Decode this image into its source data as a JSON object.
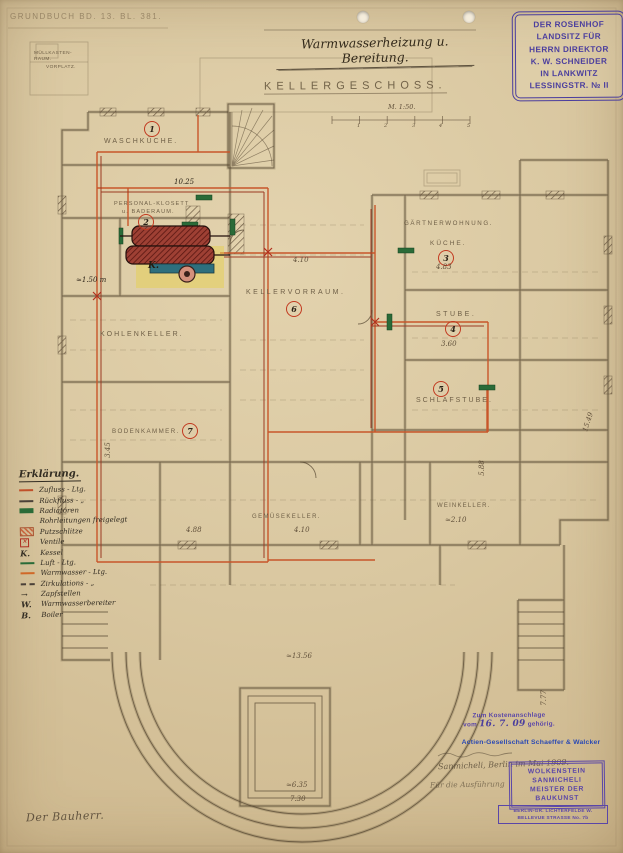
{
  "document": {
    "grundbuch": "GRUNDBUCH BD. 13. BL. 381.",
    "title": "Warmwasserheizung u. Bereitung.",
    "plan_name": "KELLERGESCHOSS.",
    "scale": "M. 1:50.",
    "bauherr_sig": "Der Bauherr."
  },
  "owner_stamp": {
    "lines": [
      "DER ROSENHOF",
      "LANDSITZ FÜR",
      "HERRN DIREKTOR",
      "K. W. SCHNEIDER",
      "IN LANKWITZ",
      "LESSINGSTR. № II"
    ]
  },
  "rooms": [
    {
      "number": "1",
      "label": "WASCHKÜCHE."
    },
    {
      "number": "2",
      "label": "PERSONAL-KLOSETT",
      "label2": "u. BADERAUM."
    },
    {
      "number": "3",
      "label": "KÜCHE."
    },
    {
      "number": "4",
      "label": "STUBE."
    },
    {
      "number": "5",
      "label": "SCHLAFSTUBE."
    },
    {
      "number": "6",
      "label": "KELLERVORRAUM."
    },
    {
      "number": "7",
      "label": "BODENKAMMER."
    }
  ],
  "labels": {
    "gaertnerwohnung": "GÄRTNERWOHNUNG.",
    "kohlenkeller": "KOHLENKELLER.",
    "gemuesekeller": "GEMÜSEKELLER.",
    "weinkeller": "WEINKELLER.",
    "muellraum": "MÜLLKASTEN-RAUM.",
    "vorplatz": "VORPLATZ.",
    "kessel_mark": "K."
  },
  "dimensions": [
    "4.10",
    "4.83",
    "3.60",
    "3.45",
    "4.88",
    "4.10",
    "≈2.10",
    "5.88",
    "≈1.50 m",
    "≈13.56",
    "≈6.35",
    "7.30",
    "15.49",
    "7.77",
    "10.25"
  ],
  "scale_bar": {
    "ticks": [
      "1",
      "2",
      "3",
      "4",
      "5"
    ]
  },
  "legend": {
    "title": "Erklärung.",
    "items": [
      {
        "symbol": "pipe-red",
        "label": "Zufluss - Ltg."
      },
      {
        "symbol": "pipe-dark",
        "label": "Rückfluss -  „"
      },
      {
        "symbol": "radiator-green",
        "label": "Radiatoren"
      },
      {
        "symbol": "none",
        "label": "Rohrleitungen freigelegt"
      },
      {
        "symbol": "hatched-box",
        "label": "Putzschlitze"
      },
      {
        "symbol": "valve",
        "label": "Ventile"
      },
      {
        "symbol": "letter",
        "key": "K.",
        "label": "Kessel"
      },
      {
        "symbol": "pipe-green",
        "label": "Luft - Ltg."
      },
      {
        "symbol": "pipe-orange",
        "label": "Warmwasser - Ltg."
      },
      {
        "symbol": "pipe-dashed",
        "label": "Zirkulations -  „"
      },
      {
        "symbol": "arrow",
        "key": "→",
        "label": "Zapfstellen"
      },
      {
        "symbol": "letter",
        "key": "W.",
        "label": "Warmwasserbereiter"
      },
      {
        "symbol": "letter",
        "key": "B.",
        "label": "Boiler"
      }
    ]
  },
  "approval": {
    "cost_stamp": {
      "line1": "Zum Kostenanschlage",
      "prefix": "vom",
      "date": "16. 7. 09",
      "suffix": "gehörig."
    },
    "company_stamp": "Actien-Gesellschaft Schaeffer & Walcker",
    "note_name": "Sanmicheli,",
    "note_city_date": "Berlin im Mai 1909.",
    "note_execution": "Für die Ausführung",
    "architect_stamp": {
      "lines": [
        "WOLKENSTEIN",
        "SANMICHELI",
        "MEISTER DER",
        "BAUKUNST"
      ]
    },
    "address_stamp": {
      "lines": [
        "BERLIN-GR. LICHTERFELDE W.",
        "BELLEVUE STRASSE No. 7b"
      ]
    }
  }
}
